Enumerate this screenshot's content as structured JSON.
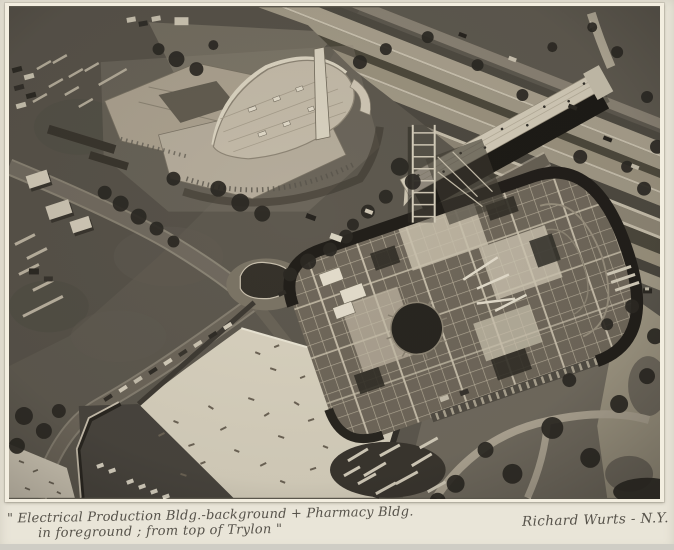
{
  "caption": {
    "line1": "\" Electrical Production Bldg.-background + Pharmacy Bldg.",
    "line2": "in foreground ;  from top of  Trylon \"",
    "signature": "Richard Wurts - N.Y."
  },
  "colors": {
    "mat": "#e9e5d8",
    "photo-paper": "#f3eee0",
    "ink": "#56524a"
  },
  "photo_regions": [
    "dirt-construction-field",
    "electrical-production-building",
    "highway-lanes",
    "pedestrian-bridge",
    "pharmacy-building-steel-framing",
    "white-exhibit-roof",
    "lawns-and-paths"
  ]
}
